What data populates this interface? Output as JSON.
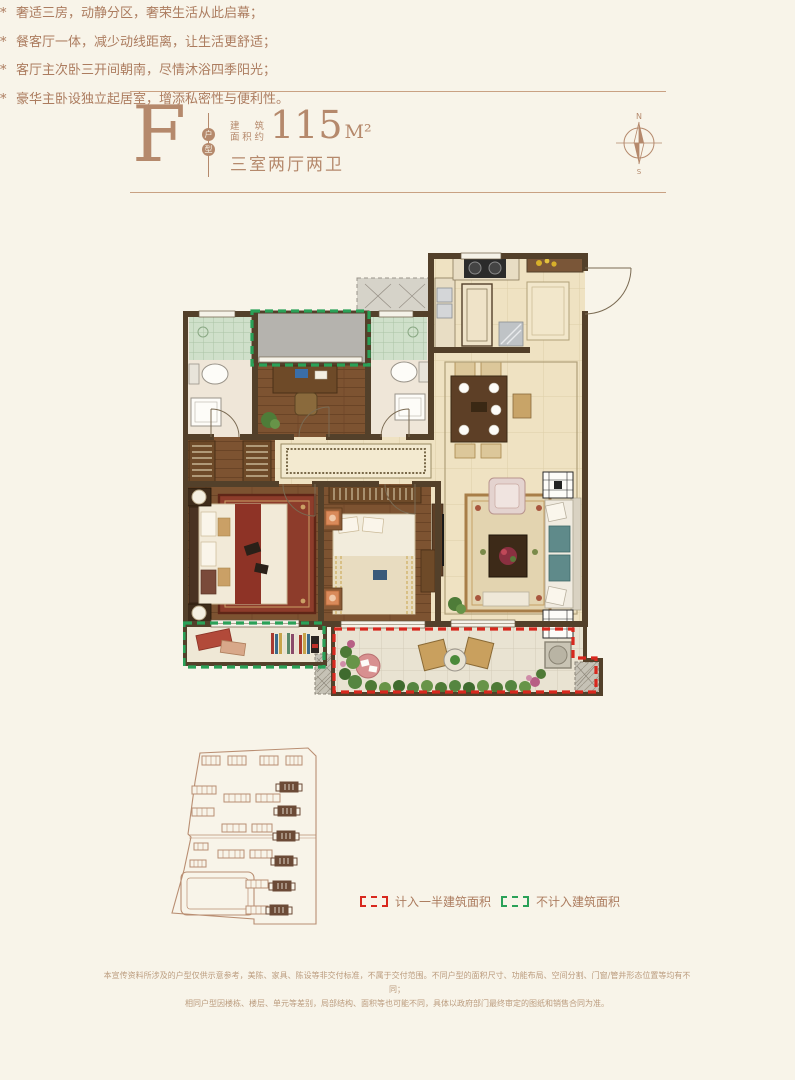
{
  "colors": {
    "accent": "#b5896c",
    "legend_red": "#d8281e",
    "legend_green": "#2aa158",
    "page_bg": "#f8f4e9"
  },
  "header": {
    "unit_letter": "F",
    "unit_type_char1": "户",
    "unit_type_char2": "型",
    "area_prefix_line1": "建筑",
    "area_prefix_line2": "面积约",
    "area_value": "115",
    "area_unit": "M²",
    "layout_text": "三室两厅两卫"
  },
  "compass": {
    "north": "N",
    "south": "S"
  },
  "features": {
    "marker": "*",
    "items": [
      "奢适三房，动静分区，奢荣生活从此启幕；",
      "餐客厅一体，减少动线距离，让生活更舒适；",
      "客厅主次卧三开间朝南，尽情沐浴四季阳光；",
      "豪华主卧设独立起居室，增添私密性与便利性。"
    ]
  },
  "legend": {
    "half_area": {
      "label": "计入一半建筑面积",
      "color": "#d8281e"
    },
    "excluded": {
      "label": "不计入建筑面积",
      "color": "#2aa158"
    }
  },
  "disclaimer": {
    "line1": "本宣传资料所涉及的户型仅供示意参考，美陈、家具、陈设等非交付标准，不属于交付范围。不同户型的面积尺寸、功能布局、空间分割、门窗/管井形态位置等均有不同；",
    "line2": "相同户型因楼栋、楼层、单元等差别，局部结构、面积等也可能不同，具体以政府部门最终审定的图纸和销售合同为准。"
  }
}
